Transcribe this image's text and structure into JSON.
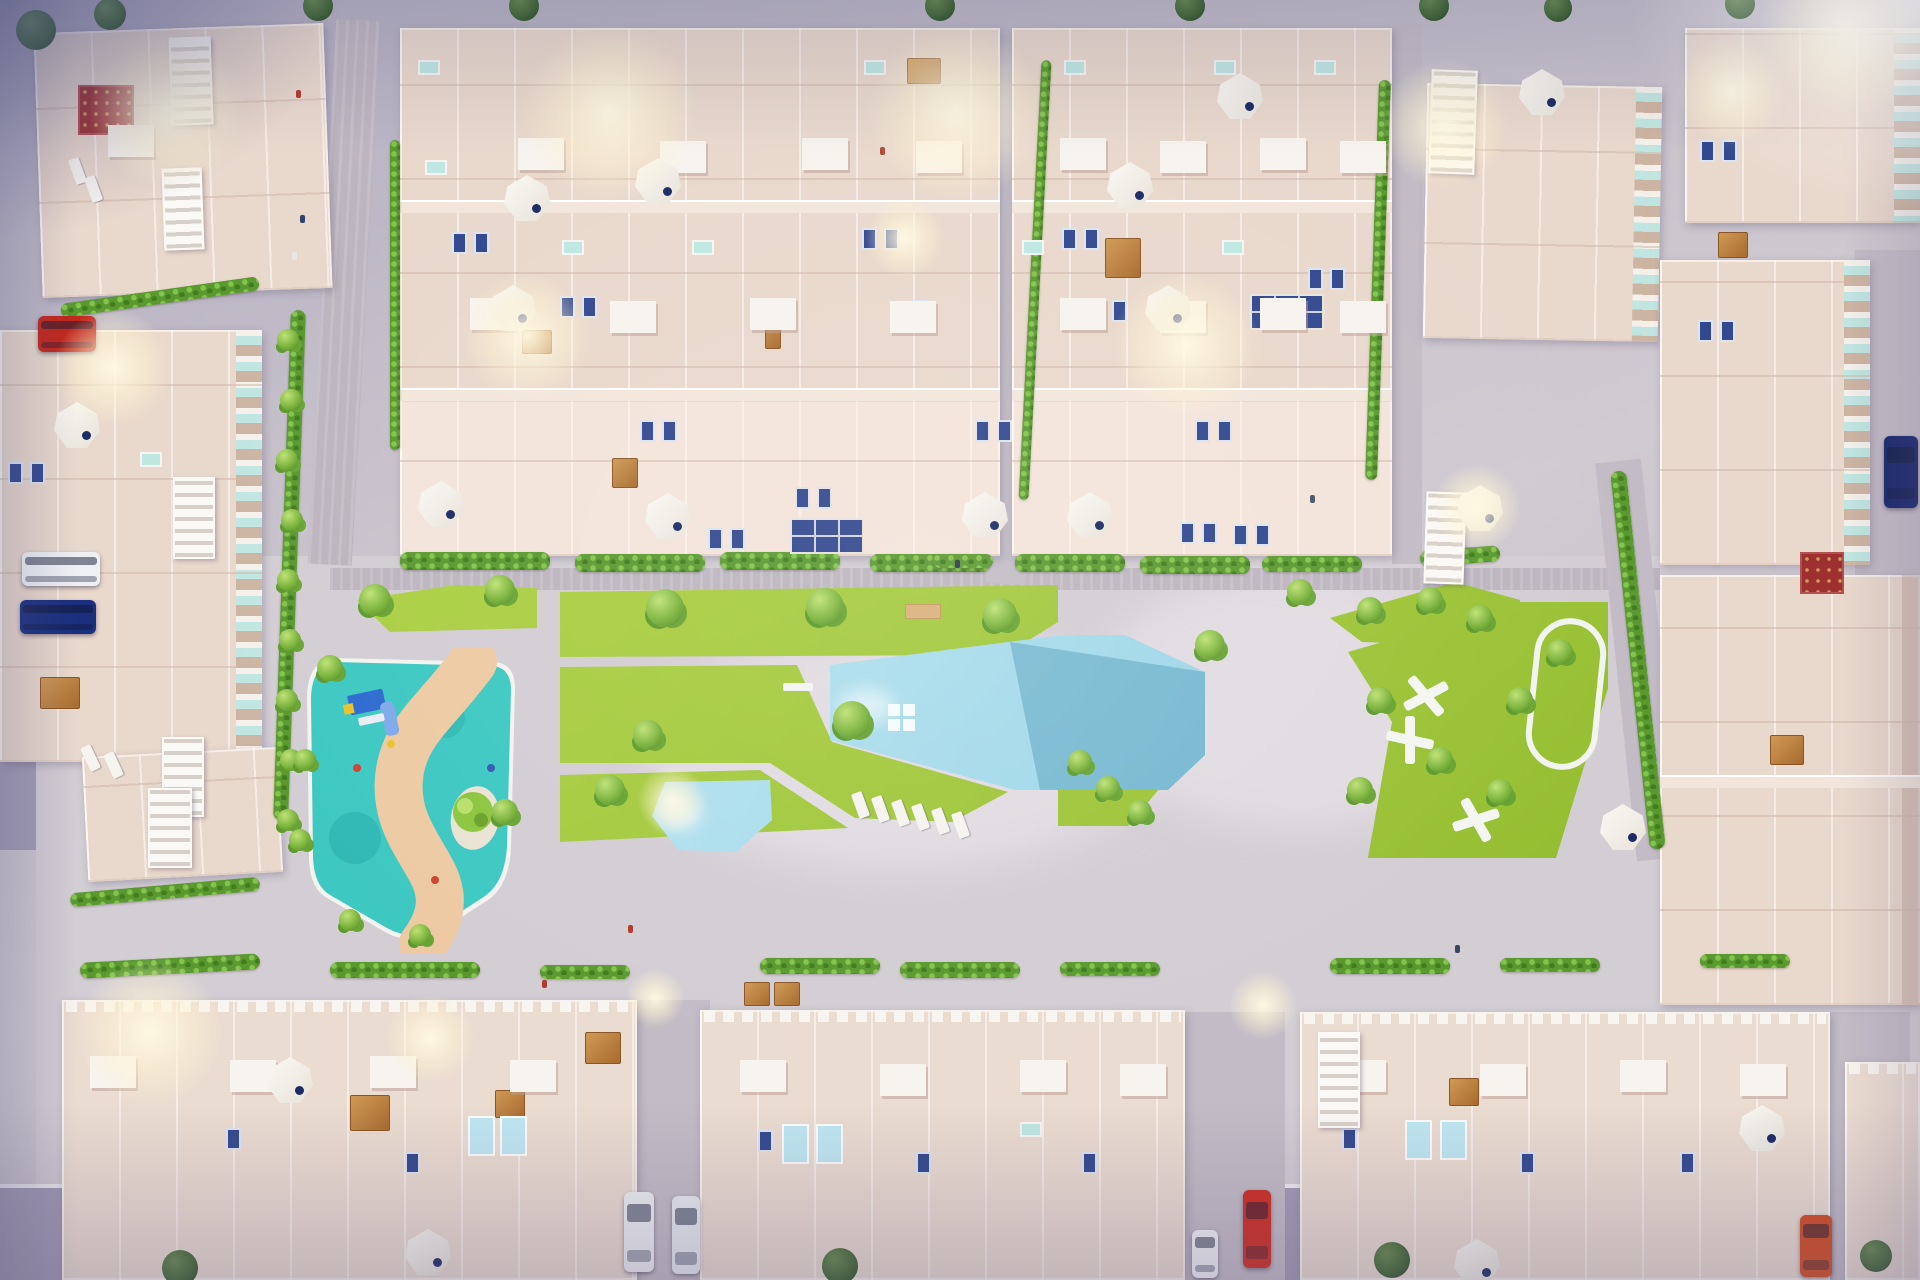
{
  "palette": {
    "pavement_light": "#d3cdd4",
    "pavement_mid": "#c3bcc6",
    "pavement_brick": "#bdb5bf",
    "road_dark": "#a29bb4",
    "building_base": "#e9d8cc",
    "building_light": "#f2e6dc",
    "building_bottom": "#ebdcd1",
    "window_blue": "#32488f",
    "glass_teal": "#bfe7e2",
    "lawn": "#a6cb3f",
    "hedge": "#5a9930",
    "pool_light": "#b7e3f0",
    "pool_deep": "#72b4cd",
    "playground_teal": "#3ec8c2",
    "sand": "#edcaa3",
    "island": "#eae3d3",
    "play_blue": "#2e6bcf",
    "wood": "#b5773a",
    "glow": "#fff4d2",
    "car_red": "#c1271c",
    "car_navy": "#1a2f7e",
    "car_white": "#eef0f4",
    "car_orange": "#d2491f"
  },
  "scene": {
    "glows": [
      [
        168,
        110,
        80
      ],
      [
        610,
        112,
        90
      ],
      [
        956,
        112,
        90
      ],
      [
        527,
        336,
        65
      ],
      [
        1186,
        346,
        75
      ],
      [
        113,
        368,
        60
      ],
      [
        1445,
        124,
        65
      ],
      [
        1732,
        90,
        55
      ],
      [
        150,
        1032,
        75
      ],
      [
        430,
        1038,
        45
      ],
      [
        655,
        998,
        30
      ],
      [
        1263,
        1005,
        35
      ],
      [
        672,
        800,
        35
      ],
      [
        1477,
        508,
        45
      ],
      [
        905,
        238,
        40
      ],
      [
        1850,
        28,
        90
      ]
    ],
    "umbrellas": [
      [
        527,
        198
      ],
      [
        658,
        181
      ],
      [
        513,
        308
      ],
      [
        441,
        504
      ],
      [
        668,
        516
      ],
      [
        985,
        515
      ],
      [
        1130,
        185
      ],
      [
        1240,
        96
      ],
      [
        1168,
        308
      ],
      [
        1090,
        515
      ],
      [
        1542,
        92
      ],
      [
        1480,
        508
      ],
      [
        1623,
        827
      ],
      [
        1762,
        1128
      ],
      [
        77,
        425
      ],
      [
        290,
        1080
      ],
      [
        1477,
        1262
      ],
      [
        428,
        1252
      ]
    ],
    "trees": [
      [
        375,
        600,
        16
      ],
      [
        500,
        590,
        15
      ],
      [
        665,
        608,
        19
      ],
      [
        825,
        607,
        19
      ],
      [
        1000,
        615,
        17
      ],
      [
        648,
        735,
        15
      ],
      [
        852,
        720,
        19
      ],
      [
        610,
        790,
        15
      ],
      [
        505,
        812,
        13
      ],
      [
        1080,
        762,
        12
      ],
      [
        1108,
        788,
        12
      ],
      [
        1140,
        812,
        12
      ],
      [
        1210,
        645,
        15
      ],
      [
        1300,
        592,
        13
      ],
      [
        1370,
        610,
        13
      ],
      [
        1430,
        600,
        13
      ],
      [
        1480,
        618,
        13
      ],
      [
        1380,
        700,
        13
      ],
      [
        1360,
        790,
        13
      ],
      [
        1440,
        760,
        13
      ],
      [
        1520,
        700,
        13
      ],
      [
        1500,
        792,
        13
      ],
      [
        1560,
        652,
        13
      ],
      [
        288,
        340,
        11
      ],
      [
        291,
        400,
        11
      ],
      [
        287,
        460,
        11
      ],
      [
        292,
        520,
        11
      ],
      [
        288,
        580,
        11
      ],
      [
        290,
        640,
        11
      ],
      [
        287,
        700,
        11
      ],
      [
        291,
        760,
        11
      ],
      [
        288,
        820,
        11
      ],
      [
        330,
        668,
        13
      ],
      [
        305,
        760,
        11
      ],
      [
        300,
        840,
        11
      ],
      [
        350,
        920,
        11
      ],
      [
        420,
        935,
        11
      ]
    ],
    "street_trees": [
      [
        318,
        6,
        15
      ],
      [
        524,
        6,
        15
      ],
      [
        940,
        6,
        15
      ],
      [
        1190,
        6,
        15
      ],
      [
        1434,
        6,
        15
      ],
      [
        1740,
        4,
        15
      ],
      [
        1558,
        8,
        14
      ],
      [
        180,
        1268,
        18
      ],
      [
        840,
        1266,
        18
      ],
      [
        1392,
        1260,
        18
      ],
      [
        1876,
        1256,
        16
      ],
      [
        36,
        30,
        20
      ],
      [
        110,
        14,
        16
      ]
    ],
    "hedges": [
      [
        400,
        552,
        150,
        18,
        0
      ],
      [
        575,
        554,
        130,
        18,
        0
      ],
      [
        720,
        552,
        120,
        18,
        0
      ],
      [
        870,
        554,
        120,
        18,
        0
      ],
      [
        1015,
        554,
        110,
        18,
        0
      ],
      [
        1140,
        556,
        110,
        18,
        0
      ],
      [
        1262,
        556,
        100,
        16,
        0
      ],
      [
        1420,
        548,
        80,
        16,
        -4
      ],
      [
        1030,
        60,
        10,
        440,
        3
      ],
      [
        1372,
        80,
        12,
        400,
        2
      ],
      [
        1630,
        470,
        16,
        380,
        -6
      ],
      [
        282,
        310,
        15,
        510,
        2
      ],
      [
        390,
        140,
        10,
        310,
        0
      ],
      [
        80,
        958,
        180,
        16,
        -3
      ],
      [
        330,
        962,
        150,
        16,
        0
      ],
      [
        540,
        965,
        90,
        14,
        0
      ],
      [
        760,
        958,
        120,
        16,
        0
      ],
      [
        900,
        962,
        120,
        16,
        0
      ],
      [
        1060,
        962,
        100,
        14,
        0
      ],
      [
        1330,
        958,
        120,
        16,
        0
      ],
      [
        1500,
        958,
        100,
        14,
        0
      ],
      [
        1700,
        954,
        90,
        14,
        0
      ],
      [
        60,
        290,
        200,
        14,
        -8
      ],
      [
        933,
        554,
        60,
        14,
        0
      ],
      [
        70,
        885,
        190,
        14,
        -5
      ]
    ],
    "panels_blue": [
      [
        452,
        232
      ],
      [
        474,
        232
      ],
      [
        560,
        296
      ],
      [
        582,
        296
      ],
      [
        640,
        420
      ],
      [
        662,
        420
      ],
      [
        708,
        528
      ],
      [
        730,
        528
      ],
      [
        795,
        487
      ],
      [
        817,
        487
      ],
      [
        862,
        228
      ],
      [
        884,
        228
      ],
      [
        912,
        300
      ],
      [
        975,
        420
      ],
      [
        997,
        420
      ],
      [
        1062,
        228
      ],
      [
        1084,
        228
      ],
      [
        1112,
        300
      ],
      [
        1195,
        420
      ],
      [
        1217,
        420
      ],
      [
        1233,
        524
      ],
      [
        1255,
        524
      ],
      [
        1308,
        268
      ],
      [
        1330,
        268
      ],
      [
        1180,
        522
      ],
      [
        1202,
        522
      ],
      [
        8,
        462
      ],
      [
        30,
        462
      ],
      [
        1700,
        140
      ],
      [
        1722,
        140
      ],
      [
        1698,
        320
      ],
      [
        1720,
        320
      ],
      [
        226,
        1128
      ],
      [
        405,
        1152
      ],
      [
        758,
        1130
      ],
      [
        916,
        1152
      ],
      [
        1082,
        1152
      ],
      [
        1342,
        1128
      ],
      [
        1520,
        1152
      ],
      [
        1680,
        1152
      ]
    ],
    "panels_teal": [
      [
        418,
        60
      ],
      [
        562,
        240
      ],
      [
        692,
        240
      ],
      [
        864,
        60
      ],
      [
        1022,
        240
      ],
      [
        1214,
        60
      ],
      [
        140,
        452
      ],
      [
        1020,
        1122
      ],
      [
        1064,
        60
      ],
      [
        1222,
        240
      ],
      [
        1314,
        60
      ],
      [
        425,
        160
      ]
    ],
    "solar_grids": [
      [
        790,
        518
      ],
      [
        1250,
        294
      ]
    ],
    "wood_tables": [
      [
        612,
        458,
        26,
        30
      ],
      [
        522,
        330,
        30,
        24
      ],
      [
        765,
        305,
        16,
        44
      ],
      [
        585,
        1032,
        36,
        32
      ],
      [
        495,
        1090,
        30,
        28
      ],
      [
        744,
        982,
        26,
        24
      ],
      [
        774,
        982,
        26,
        24
      ],
      [
        1449,
        1078,
        30,
        28
      ],
      [
        1718,
        232,
        30,
        26
      ],
      [
        1770,
        735,
        34,
        30
      ],
      [
        40,
        677,
        40,
        32
      ],
      [
        907,
        58,
        34,
        26
      ],
      [
        350,
        1095,
        40,
        36
      ],
      [
        1105,
        238,
        36,
        40
      ]
    ],
    "red_patios": [
      [
        78,
        85,
        56,
        50
      ],
      [
        1800,
        552,
        44,
        42
      ]
    ],
    "white_boxes": [
      [
        518,
        138
      ],
      [
        660,
        141
      ],
      [
        802,
        138
      ],
      [
        916,
        141
      ],
      [
        470,
        298
      ],
      [
        610,
        301
      ],
      [
        750,
        298
      ],
      [
        890,
        301
      ],
      [
        1060,
        138
      ],
      [
        1160,
        141
      ],
      [
        1260,
        138
      ],
      [
        1340,
        141
      ],
      [
        1060,
        298
      ],
      [
        1160,
        301
      ],
      [
        1260,
        298
      ],
      [
        1340,
        301
      ],
      [
        90,
        1056
      ],
      [
        230,
        1060
      ],
      [
        370,
        1056
      ],
      [
        510,
        1060
      ],
      [
        740,
        1060
      ],
      [
        880,
        1064
      ],
      [
        1020,
        1060
      ],
      [
        1120,
        1064
      ],
      [
        1340,
        1060
      ],
      [
        1480,
        1064
      ],
      [
        1620,
        1060
      ],
      [
        1740,
        1064
      ],
      [
        108,
        125
      ]
    ],
    "pools_small": [
      [
        468,
        1116
      ],
      [
        500,
        1116
      ],
      [
        782,
        1124
      ],
      [
        816,
        1124
      ],
      [
        1405,
        1120
      ],
      [
        1440,
        1120
      ]
    ],
    "pool_steps": [
      [
        888,
        704
      ],
      [
        903,
        704
      ],
      [
        888,
        719
      ],
      [
        903,
        719
      ]
    ],
    "loungers": [
      [
        72,
        158,
        -20
      ],
      [
        88,
        176,
        -20
      ],
      [
        85,
        745,
        -25
      ],
      [
        108,
        752,
        -25
      ],
      [
        855,
        792,
        -20
      ],
      [
        875,
        796,
        -20
      ],
      [
        895,
        800,
        -20
      ],
      [
        915,
        804,
        -20
      ],
      [
        935,
        808,
        -20
      ],
      [
        955,
        812,
        -20
      ]
    ],
    "stairs": [
      [
        170,
        37,
        42,
        88,
        -2
      ],
      [
        163,
        168,
        40,
        82,
        -2
      ],
      [
        173,
        477,
        42,
        82,
        0
      ],
      [
        162,
        737,
        42,
        80,
        0
      ],
      [
        1430,
        70,
        46,
        104,
        2
      ],
      [
        1425,
        492,
        40,
        92,
        2
      ],
      [
        1318,
        1032,
        42,
        96,
        0
      ],
      [
        148,
        788,
        44,
        80,
        0
      ]
    ],
    "cars": [
      {
        "name": "car-red-top-left",
        "x": 38,
        "y": 316,
        "w": 58,
        "h": 36,
        "color": "#c1271c"
      },
      {
        "name": "car-white-left",
        "x": 22,
        "y": 552,
        "w": 78,
        "h": 34,
        "color": "#eef0f4"
      },
      {
        "name": "car-navy-left",
        "x": 20,
        "y": 600,
        "w": 76,
        "h": 34,
        "color": "#1a2f7e"
      },
      {
        "name": "car-white-street-a",
        "x": 624,
        "y": 1192,
        "w": 30,
        "h": 80,
        "color": "#eef0f4"
      },
      {
        "name": "car-white-street-b",
        "x": 672,
        "y": 1196,
        "w": 28,
        "h": 78,
        "color": "#e8ebf1"
      },
      {
        "name": "car-white-van",
        "x": 1192,
        "y": 1230,
        "w": 26,
        "h": 48,
        "color": "#f2f3f7"
      },
      {
        "name": "car-red-bottom",
        "x": 1243,
        "y": 1190,
        "w": 28,
        "h": 78,
        "color": "#cf2a1e"
      },
      {
        "name": "car-orange-bottom-right",
        "x": 1800,
        "y": 1215,
        "w": 32,
        "h": 62,
        "color": "#d2491f"
      },
      {
        "name": "car-navy-right-edge",
        "x": 1884,
        "y": 436,
        "w": 34,
        "h": 72,
        "color": "#16246b"
      }
    ],
    "people": [
      [
        296,
        90,
        "#b03a2e"
      ],
      [
        300,
        215,
        "#2e4468"
      ],
      [
        880,
        147,
        "#b03a2e"
      ],
      [
        292,
        252,
        "#e8e8e8"
      ],
      [
        955,
        560,
        "#30364a"
      ],
      [
        628,
        925,
        "#b03a2e"
      ],
      [
        1310,
        495,
        "#4a5568"
      ],
      [
        1455,
        945,
        "#39465e"
      ],
      [
        542,
        980,
        "#b03a2e"
      ]
    ]
  }
}
